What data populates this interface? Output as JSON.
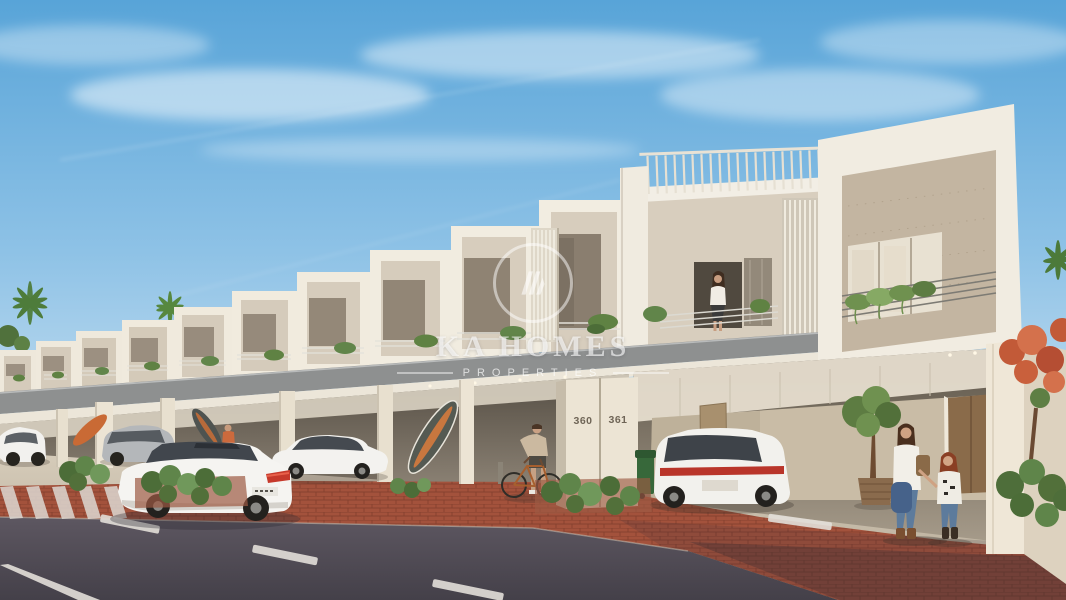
{
  "meta": {
    "alt": "Sunny 3D architectural rendering of a row of modern two-storey townhouses with balconies, covered carports, white cars, residents and a street in front"
  },
  "watermark": {
    "brand": "KA HOMES",
    "tagline": "PROPERTIES",
    "emblem": "monogram-ring-icon"
  },
  "houses": {
    "numbers": {
      "left": "360",
      "right": "361"
    }
  },
  "palette": {
    "sky_top": "#58a4d8",
    "sky_horizon": "#ecf5fb",
    "facade_white": "#f1ece1",
    "facade_cream": "#d6ccbc",
    "facade_taupe": "#c3b5a1",
    "balcony_band_gray": "#8e9090",
    "glass_shadow": "#6b655c",
    "foliage_green": "#5f8243",
    "flower_orange": "#c75f3f",
    "paver_red": "#a3523c",
    "asphalt": "#56515b",
    "marking_white": "#e3dfd9",
    "car_white": "#f4f3f0",
    "denim_blue": "#5d7b9c"
  }
}
